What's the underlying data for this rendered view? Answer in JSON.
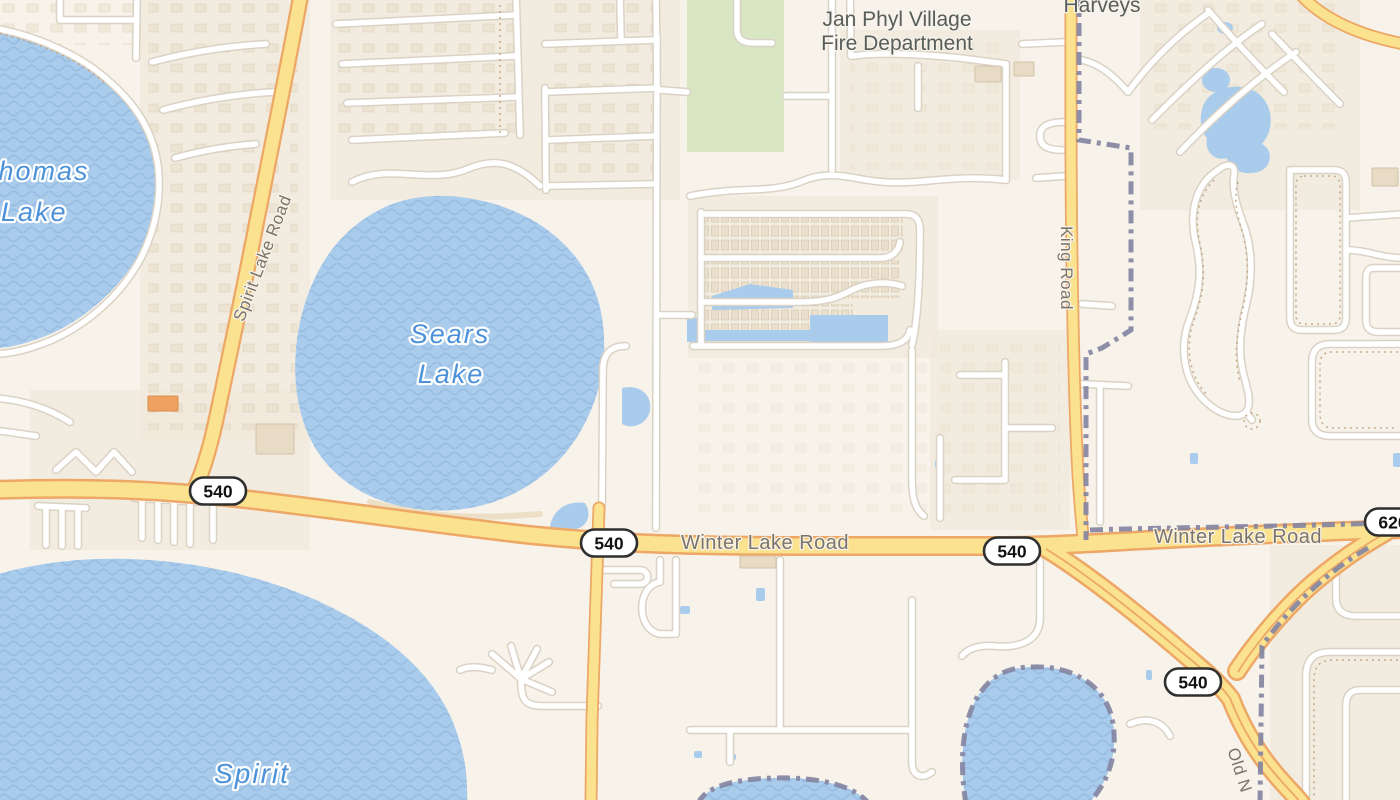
{
  "map": {
    "kind": "street-map",
    "poi_labels": {
      "fire_department": {
        "line1": "Jan Phyl Village",
        "line2": "Fire Department"
      },
      "harveys": {
        "text": "Harveys"
      }
    },
    "road_labels": {
      "spirit_lake_road": {
        "text": "Spirit Lake Road"
      },
      "winter_lake_road_west": {
        "text": "Winter Lake Road"
      },
      "winter_lake_road_east": {
        "text": "Winter Lake Road"
      },
      "king_road": {
        "text": "King Road"
      },
      "old_n_road": {
        "text": "Old N"
      }
    },
    "water_labels": {
      "thomas_lake": {
        "line1": "Thomas",
        "line2": "Lake"
      },
      "sears_lake": {
        "line1": "Sears",
        "line2": "Lake"
      },
      "spirit_lake": {
        "line1": "Spirit",
        "line2": "Lake"
      }
    },
    "route_shields": {
      "sh540_junction_west": {
        "number": "540"
      },
      "sh540_center": {
        "number": "540"
      },
      "sh540_east": {
        "number": "540"
      },
      "sh540_south": {
        "number": "540"
      },
      "sh620_east": {
        "number": "620"
      }
    },
    "colors": {
      "land": "#f7f2ea",
      "water": "#a9cbec",
      "park": "#d8e6c4",
      "highway_fill": "#fae28f",
      "highway_casing": "#eda766",
      "road_fill": "#ffffff",
      "road_casing": "#dad2c4",
      "boundary": "#8486a2",
      "water_label": "#4d92d8",
      "road_label": "#7c7467",
      "poi_label": "#575d59"
    }
  }
}
